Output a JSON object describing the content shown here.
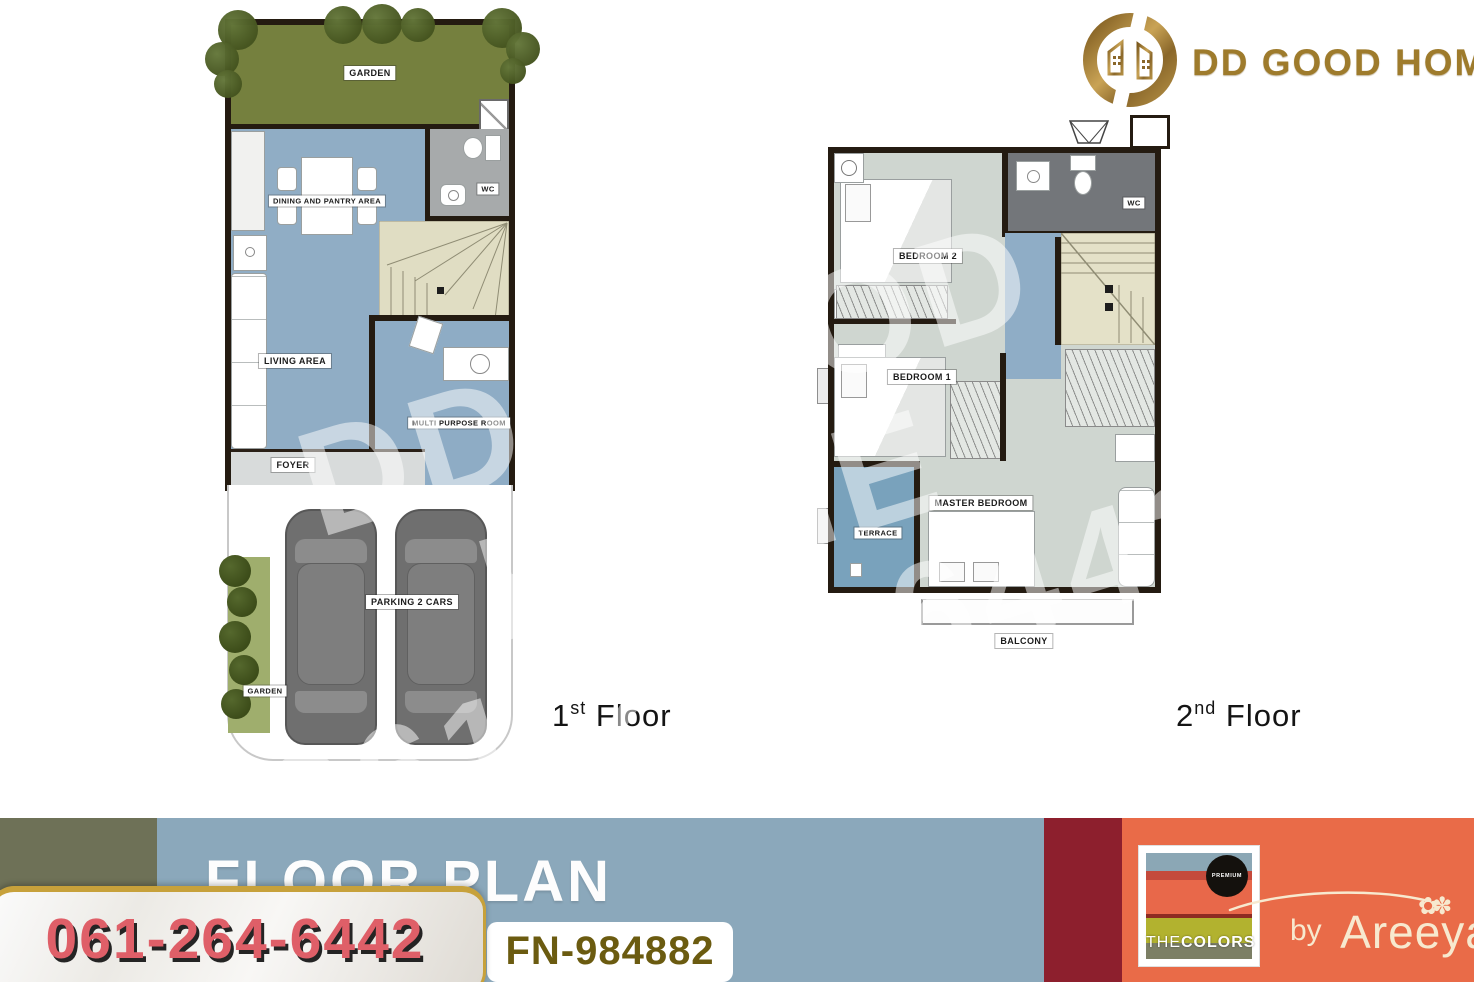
{
  "brand": {
    "logo_text": "DD GOOD HOME",
    "emblem_icon": "dd-monogram-houses"
  },
  "plans": {
    "floor1": {
      "caption": {
        "num": "1",
        "sup": "st",
        "word": "Floor"
      },
      "rooms": {
        "garden": "GARDEN",
        "dining": "DINING AND PANTRY AREA",
        "wc": "WC",
        "living": "LIVING AREA",
        "multi_purpose": "MULTI PURPOSE ROOM",
        "foyer": "FOYER",
        "parking": "PARKING 2 CARS",
        "side_garden": "GARDEN"
      }
    },
    "floor2": {
      "caption": {
        "num": "2",
        "sup": "nd",
        "word": "Floor"
      },
      "rooms": {
        "bedroom2": "BEDROOM 2",
        "wc": "WC",
        "bedroom1": "BEDROOM 1",
        "master": "MASTER BEDROOM",
        "terrace": "TERRACE",
        "balcony": "BALCONY"
      }
    }
  },
  "watermark": {
    "line1": "DD GOOD HOME",
    "line2": "061-264-6442"
  },
  "banner": {
    "title": "FLOOR PLAN",
    "phone": "061-264-6442",
    "ref_code": "FN-984882",
    "colors": {
      "blue": "#8ba8bb",
      "olive": "#6e7157",
      "maroon": "#8d1f2d",
      "orange": "#e96b48",
      "gold": "#c7a13b",
      "phone_red": "#df5f68",
      "fn_text": "#6b5b10",
      "logo_gold": "#9e7b2c"
    }
  },
  "colors_brand": {
    "premium": "PREMIUM",
    "the": "THE",
    "colors": "COLORS",
    "by": "by",
    "name": "Areeya"
  }
}
